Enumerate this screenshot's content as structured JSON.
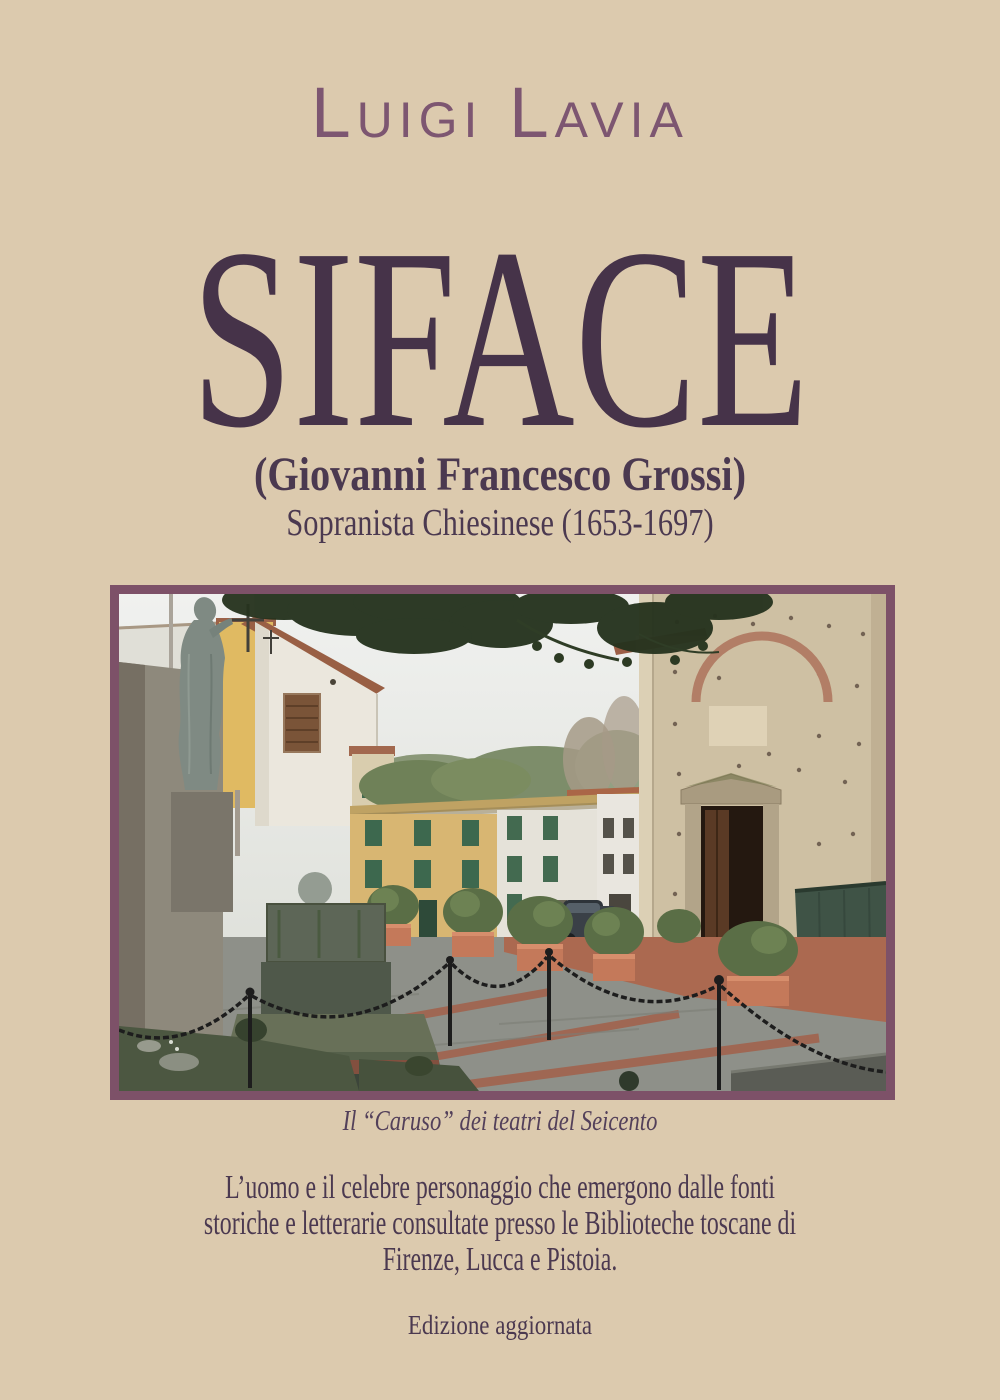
{
  "cover": {
    "author": "Luigi Lavia",
    "title": "SIFACE",
    "subtitle_primary": "(Giovanni Francesco Grossi)",
    "subtitle_secondary": "Sopranista Chiesinese (1653-1697)",
    "photo_caption": "Il “Caruso” dei teatri del Seicento",
    "description_lines": [
      "L’uomo e il celebre personaggio che emergono dalle fonti",
      "storiche e letterarie consultate presso le Biblioteche toscane di",
      "Firenze, Lucca e Pistoia."
    ],
    "edition_note": "Edizione aggiornata",
    "photo_description": "Piazza with statue monument, Tuscan houses and Romanesque stone church facade",
    "colors": {
      "background": "#dccaae",
      "title_ink": "#463349",
      "author_ink": "#7d5671",
      "text_ink": "#4b3950",
      "frame_border": "#7d5168"
    }
  }
}
